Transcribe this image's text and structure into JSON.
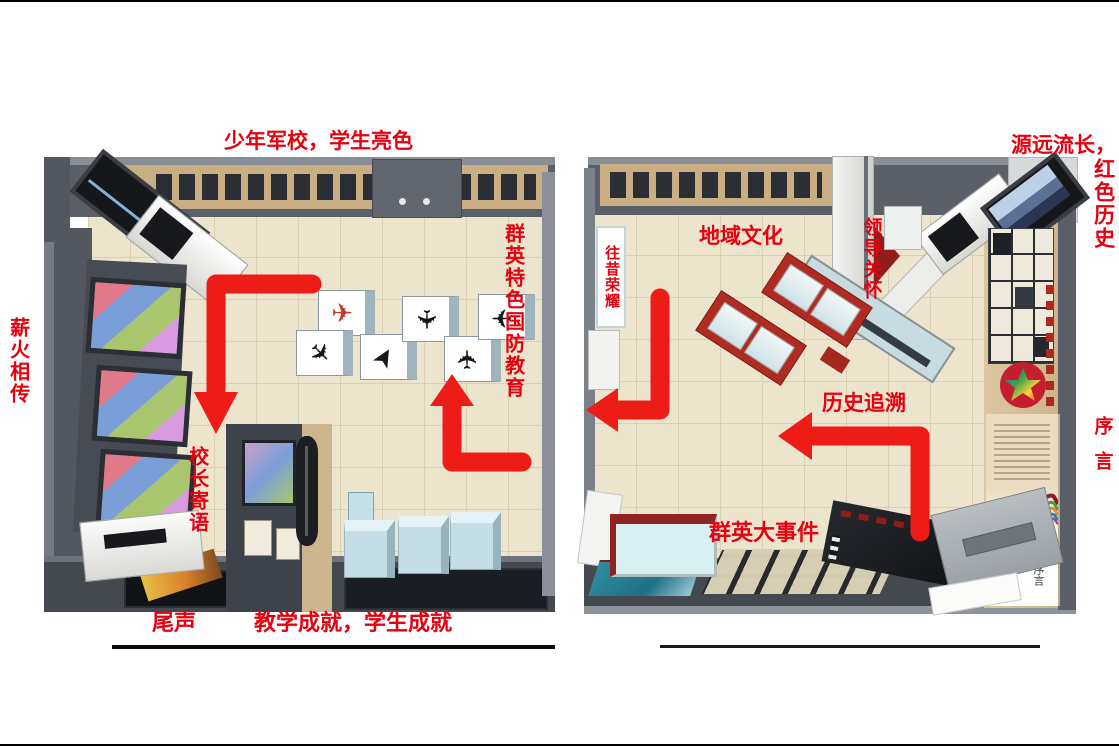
{
  "title": "exhibition-hall-flow-plan",
  "colors": {
    "label_red": "#e60010",
    "arrow_red": "#ee1c16",
    "wall_gray": "#5a5f68",
    "floor_beige": "#ece4cd",
    "wood_tan": "#c9ae83",
    "case_red": "#b02c22"
  },
  "labels": {
    "cadet_school": "少年军校，学生亮色",
    "torch_legacy": "薪火相传",
    "principal_message": "校长寄语",
    "epilogue": "尾声",
    "teaching_achievements": "教学成就，学生成就",
    "defense_education": "群英特色国防教育",
    "past_glory": "往昔荣耀",
    "regional_culture": "地域文化",
    "leaders_care": "领导关怀",
    "history_retrospect": "历史追溯",
    "qunying_events": "群英大事件",
    "long_history": "源远流长，",
    "red_history": "红色历史",
    "preface": "序言"
  },
  "preface_panel": {
    "en": "Preface",
    "cn": "序言"
  },
  "arrows": [
    {
      "name": "flow-arrow-entry-down",
      "line": "312,284 216,284 216,396",
      "head": "194,392 238,392 216,434"
    },
    {
      "name": "flow-arrow-center-up",
      "line": "522,462 452,462 452,402",
      "head": "430,406 474,406 452,374"
    },
    {
      "name": "flow-arrow-left-turn",
      "line": "660,298 660,410 614,410",
      "head": "618,388 618,432 586,410"
    },
    {
      "name": "flow-arrow-history-left",
      "line": "920,532 920,436 810,436",
      "head": "812,412 812,460 778,436"
    }
  ]
}
